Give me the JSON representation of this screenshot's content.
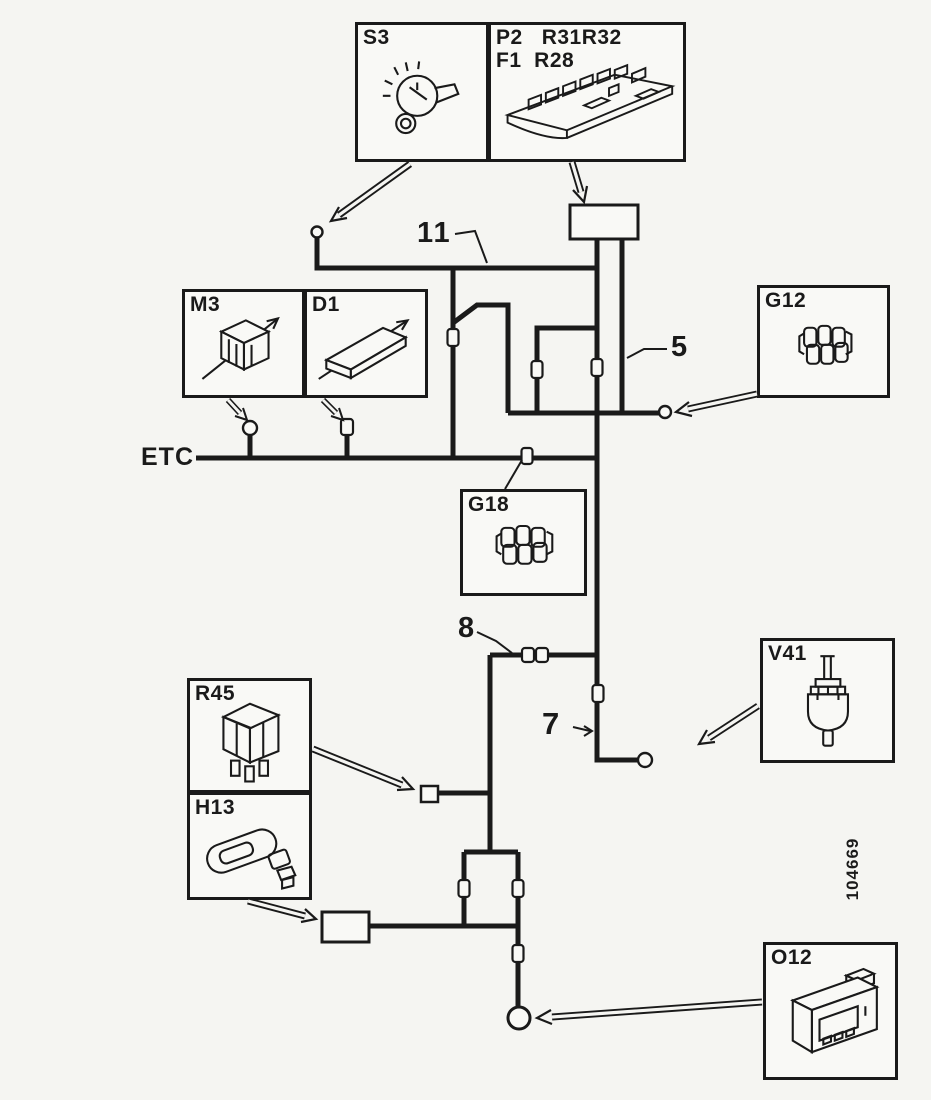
{
  "figure": {
    "bus_label": "ETC",
    "figure_number": "104669",
    "wire_labels": {
      "w11": "11",
      "w5": "5",
      "w8": "8",
      "w7": "7"
    },
    "callouts": {
      "s3": {
        "label": "S3",
        "component": "ignition-switch"
      },
      "p2f1": {
        "line1": "P2   R31R32",
        "line2": "F1  R28",
        "component": "central-fuse-relay-panel"
      },
      "m3": {
        "label": "M3",
        "component": "motor"
      },
      "d1": {
        "label": "D1",
        "component": "control-unit"
      },
      "g12": {
        "label": "G12",
        "component": "connector-block"
      },
      "g18": {
        "label": "G18",
        "component": "connector-block"
      },
      "r45": {
        "label": "R45",
        "component": "relay"
      },
      "h13": {
        "label": "H13",
        "component": "horn"
      },
      "v41": {
        "label": "V41",
        "component": "solenoid-valve"
      },
      "o12": {
        "label": "O12",
        "component": "control-module"
      }
    },
    "colors": {
      "ink": "#1a1a1a",
      "paper": "#f5f5f2"
    }
  }
}
